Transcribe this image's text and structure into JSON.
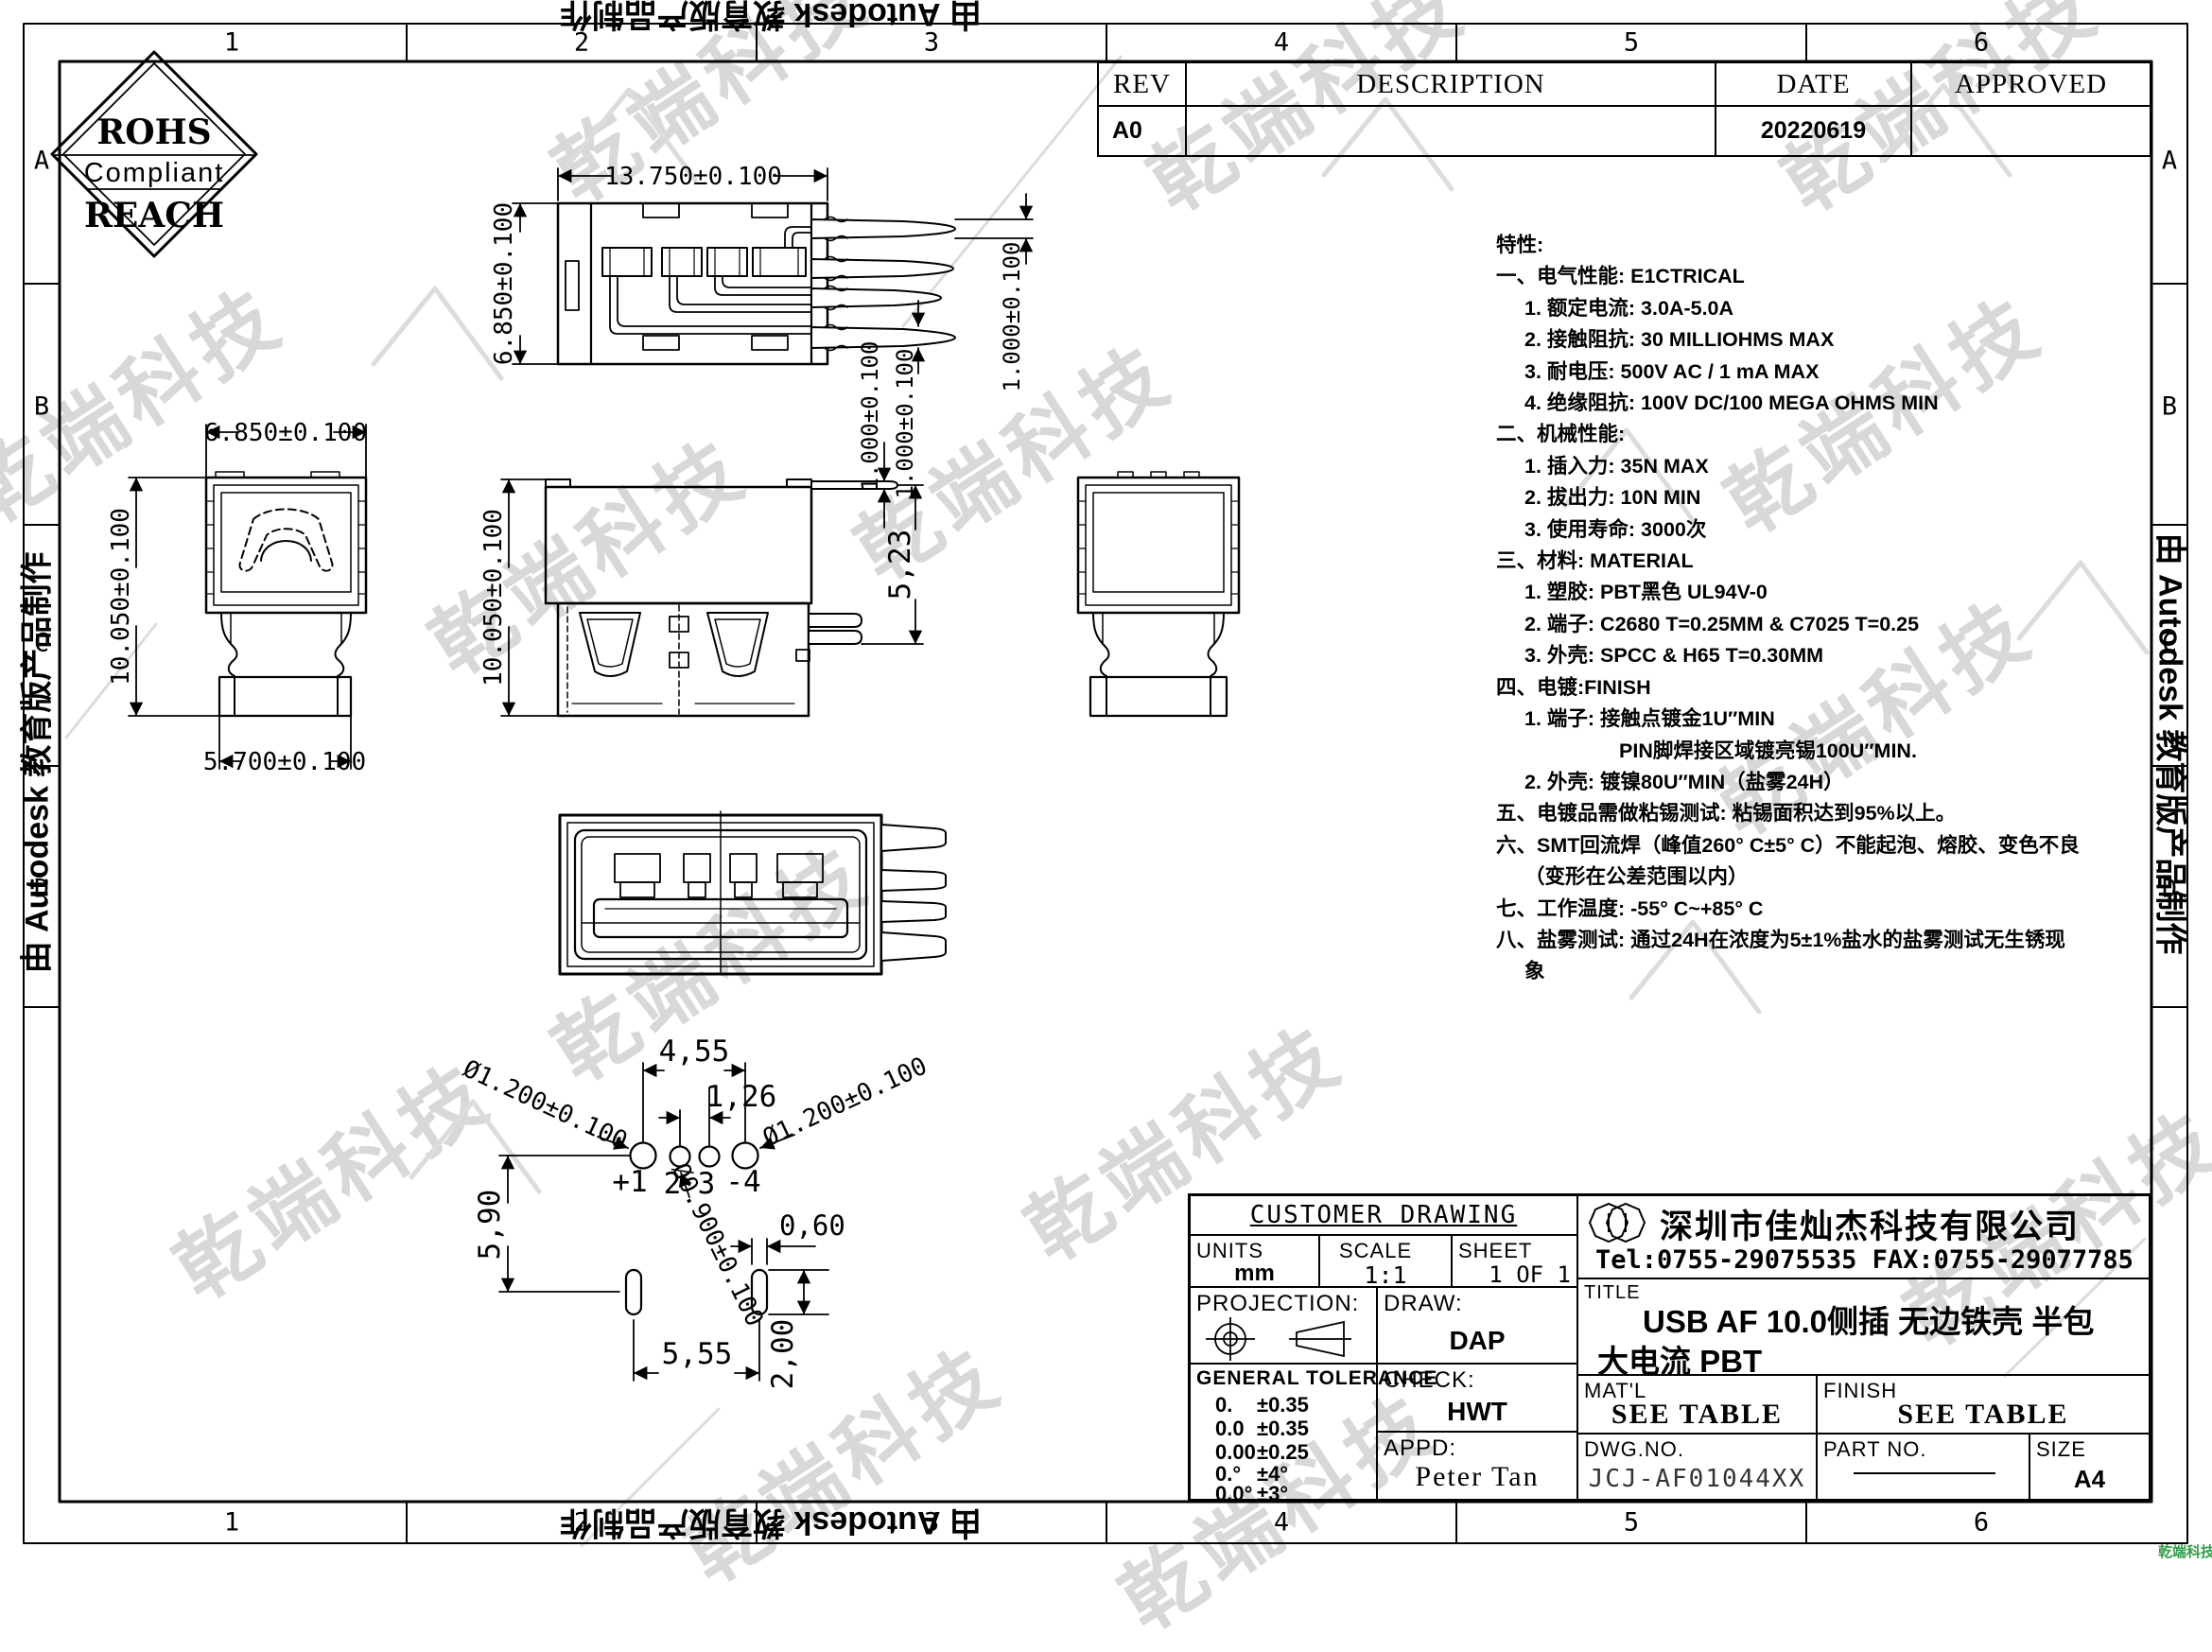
{
  "watermark": {
    "text": "乾端科技",
    "corner_text": "乾端科技"
  },
  "autodesk": {
    "text": "由 Autodesk 教育版产品制作"
  },
  "frame": {
    "cols": [
      "1",
      "2",
      "3",
      "4",
      "5",
      "6"
    ],
    "rows": [
      "A",
      "B",
      "C",
      "D"
    ]
  },
  "rohs": {
    "top": "ROHS",
    "middle": "Compliant",
    "bottom": "REACH"
  },
  "rev_table": {
    "h_rev": "REV",
    "h_desc": "DESCRIPTION",
    "h_date": "DATE",
    "h_appr": "APPROVED",
    "rev": "A0",
    "desc": "",
    "date": "20220619",
    "appr": ""
  },
  "spec": {
    "lines": [
      {
        "t": "特性:"
      },
      {
        "t": "一、电气性能: E1CTRICAL"
      },
      {
        "t": "1. 额定电流: 3.0A-5.0A"
      },
      {
        "t": "2. 接触阻抗: 30 MILLIOHMS MAX"
      },
      {
        "t": "3. 耐电压: 500V AC / 1 mA MAX"
      },
      {
        "t": "4. 绝缘阻抗: 100V DC/100 MEGA OHMS MIN"
      },
      {
        "t": "二、机械性能:"
      },
      {
        "t": "1. 插入力: 35N  MAX"
      },
      {
        "t": "2. 拔出力: 10N  MIN"
      },
      {
        "t": "3. 使用寿命: 3000次"
      },
      {
        "t": "三、材料: MATERIAL"
      },
      {
        "t": "1. 塑胶: PBT黑色 UL94V-0"
      },
      {
        "t": "2. 端子: C2680 T=0.25MM & C7025 T=0.25"
      },
      {
        "t": "3. 外壳: SPCC & H65  T=0.30MM"
      },
      {
        "t": "四、电镀:FINISH"
      },
      {
        "t": "1. 端子: 接触点镀金1U″MIN"
      },
      {
        "t": "PIN脚焊接区域镀亮锡100U″MIN."
      },
      {
        "t": "2. 外壳: 镀镍80U″MIN（盐雾24H）"
      },
      {
        "t": "五、电镀品需做粘锡测试: 粘锡面积达到95%以上。"
      },
      {
        "t": "六、SMT回流焊（峰值260° C±5° C）不能起泡、熔胶、变色不良"
      },
      {
        "t": "（变形在公差范围以内）"
      },
      {
        "t": "七、工作温度: -55° C~+85° C"
      },
      {
        "t": "八、盐雾测试: 通过24H在浓度为5±1%盐水的盐雾测试无生锈现"
      },
      {
        "t": "象"
      }
    ]
  },
  "dims": {
    "top_view": {
      "width": "13.750±0.100",
      "height": "6.850±0.100",
      "pin_a": "1.000±0.100",
      "pin_b": "1.000±0.100"
    },
    "front_view": {
      "width": "6.850±0.100",
      "height": "10.050±0.100",
      "base": "5.700±0.100"
    },
    "side_view": {
      "height": "10.050±0.100",
      "pin_drop": "5,23",
      "pin_width": "1.000±0.100"
    },
    "pin_layout": {
      "outer_pitch": "4,55",
      "inner_pitch": "1,26",
      "dia_left": "Ø1.200±0.100",
      "dia_right": "Ø1.200±0.100",
      "vertical": "5,90",
      "dia_small": "Ø0.900±0.100",
      "slot_width": "0,60",
      "slot_pitch": "5,55",
      "slot_height": "2,00",
      "pins": [
        "+1",
        "2",
        "3",
        "-4"
      ]
    }
  },
  "title_block": {
    "customer_drawing": "CUSTOMER DRAWING",
    "units_label": "UNITS",
    "units_value": "mm",
    "scale_label": "SCALE",
    "scale_value": "1:1",
    "sheet_label": "SHEET",
    "sheet_value": "1 OF 1",
    "projection_label": "PROJECTION:",
    "draw_label": "DRAW:",
    "draw_value": "DAP",
    "general_tolerance_label": "GENERAL TOLERANCE",
    "tolerances": [
      {
        "range": "0.",
        "tol": "±0.35"
      },
      {
        "range": "0.0",
        "tol": "±0.35"
      },
      {
        "range": "0.00",
        "tol": "±0.25"
      },
      {
        "range": "0.°",
        "tol": "±4°"
      },
      {
        "range": "0.0°",
        "tol": "±3°"
      }
    ],
    "check_label": "CHECK:",
    "check_value": "HWT",
    "appd_label": "APPD:",
    "appd_value": "Peter Tan",
    "company": "深圳市佳灿杰科技有限公司",
    "contact": "Tel:0755-29075535 FAX:0755-29077785",
    "title_label": "TITLE",
    "title_line1": "USB AF 10.0侧插 无边铁壳 半包",
    "title_line2": "大电流 PBT",
    "matl_label": "MAT'L",
    "matl_value": "SEE TABLE",
    "finish_label": "FINISH",
    "finish_value": "SEE TABLE",
    "dwg_no_label": "DWG.NO.",
    "dwg_no_value": "JCJ-AF01044XX",
    "part_no_label": "PART NO.",
    "size_label": "SIZE",
    "size_value": "A4"
  }
}
